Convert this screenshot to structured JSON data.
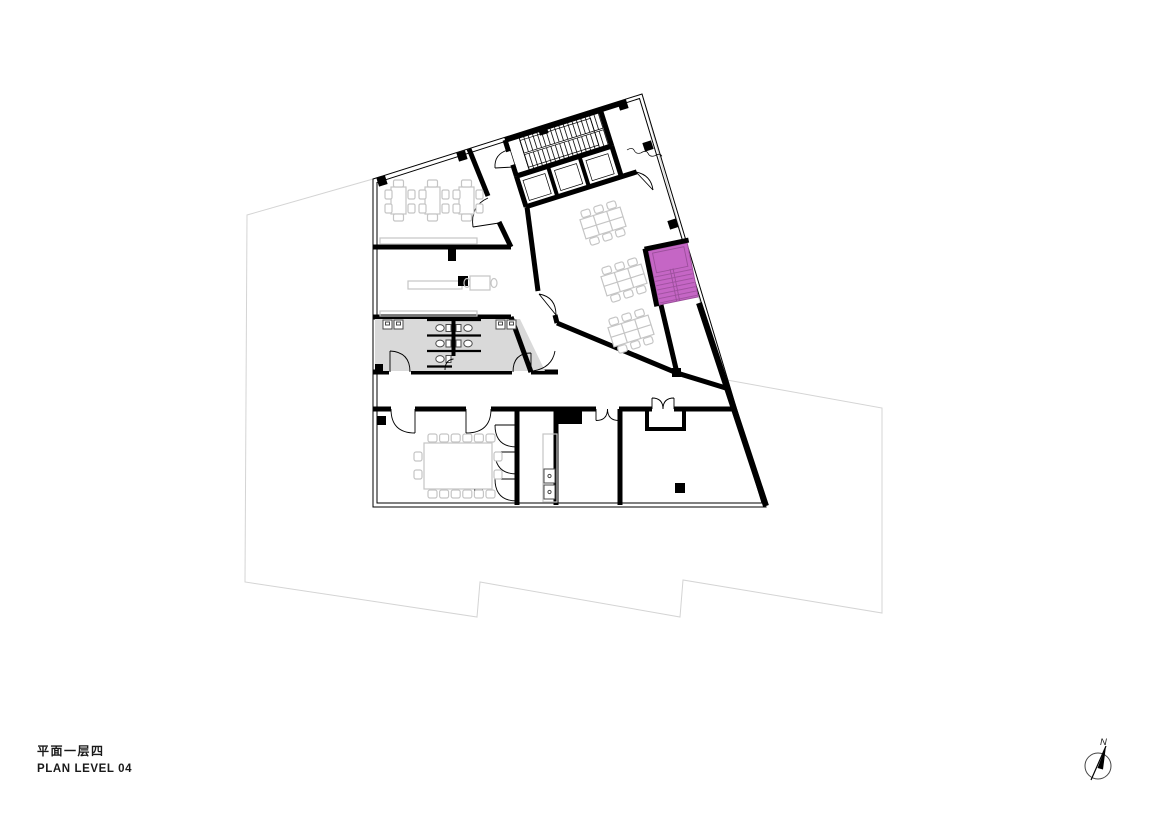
{
  "sheet": {
    "title_zh": "平面一层四",
    "title_en": "PLAN LEVEL 04"
  },
  "north": {
    "label": "N"
  },
  "colors": {
    "paper": "#ffffff",
    "wall": "#000000",
    "text": "#1a1a1a",
    "site": "#d4d4d4",
    "furniture": "#c5c5c5",
    "fixture": "#4a4a4a",
    "washroom_fill": "#d9d9d9",
    "highlight_fill": "#c566c5",
    "highlight_line": "#9c4f9c"
  }
}
